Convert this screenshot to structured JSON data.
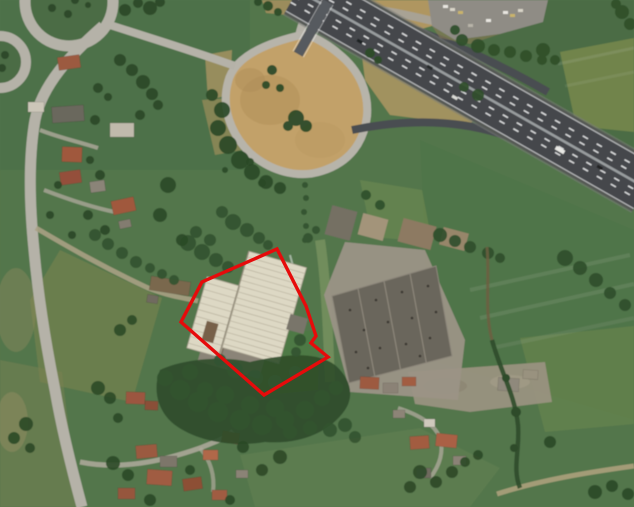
{
  "image": {
    "kind": "satellite-aerial-photo",
    "description": "Aerial satellite view of a rural area: motorway with loop on-ramp (top), roundabout (top-left), village houses along a winding road (left and bottom), a large grey warehouse and a white ribbed-roof industrial building, with a land parcel outlined in red",
    "width_px": 634,
    "height_px": 507
  },
  "annotation": {
    "parcel_outline_points": "277,249 306,306 316,336 311,343 328,357 264,395 181,322 202,282",
    "parcel_outline_color": "#e60b0b",
    "parcel_outline_width": "3.4"
  },
  "palette": {
    "field_green": "#53764c",
    "field_green_dark": "#48683f",
    "field_olive": "#76814f",
    "dry_grass_tan": "#c2a169",
    "asphalt_dark": "#44474b",
    "road_light_gray": "#b5b2a8",
    "dirt_path": "#a9a184",
    "roof_white_cream": "#ddd8c4",
    "warehouse_roof_gray": "#6a665c",
    "concrete_apron": "#9b9486",
    "roof_red": "#a0583c",
    "tree_green": "#2e4c2a"
  },
  "features": [
    "roundabout",
    "secondary-roundabout",
    "main-road",
    "motorway",
    "loop-on-ramp",
    "underpass-road",
    "parking-area",
    "dry-grass-infield",
    "village-houses",
    "barn",
    "white-roof-building",
    "warehouse-building",
    "rubble-yard",
    "tree-groups",
    "hedgerow-stream",
    "red-parcel-outline"
  ]
}
